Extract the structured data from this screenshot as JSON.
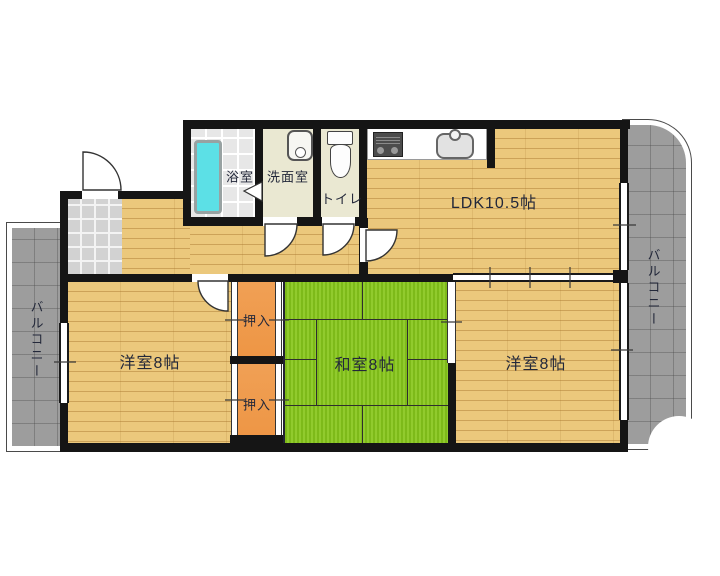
{
  "plan": {
    "type": "apartment-floorplan",
    "rooms": {
      "ldk": "LDK10.5帖",
      "bath": "浴室",
      "washroom": "洗面室",
      "toilet": "トイレ",
      "western_left": "洋室8帖",
      "japanese_room": "和室8帖",
      "western_right": "洋室8帖",
      "closet_upper": "押入",
      "closet_lower": "押入",
      "balcony_left": "バルコニー",
      "balcony_right": "バルコニー"
    },
    "colors": {
      "wall": "#151515",
      "wood_floor": "#ebc87c",
      "tatami": "#8bc822",
      "closet": "#ef9a4c",
      "balcony": "#9d9d9d",
      "bath_tile": "#e7e7e7",
      "service_floor": "#eae8d2",
      "entrance_tile": "#d2d2d2",
      "bathtub": "#5ce0e6",
      "label_text": "#23283a"
    }
  }
}
